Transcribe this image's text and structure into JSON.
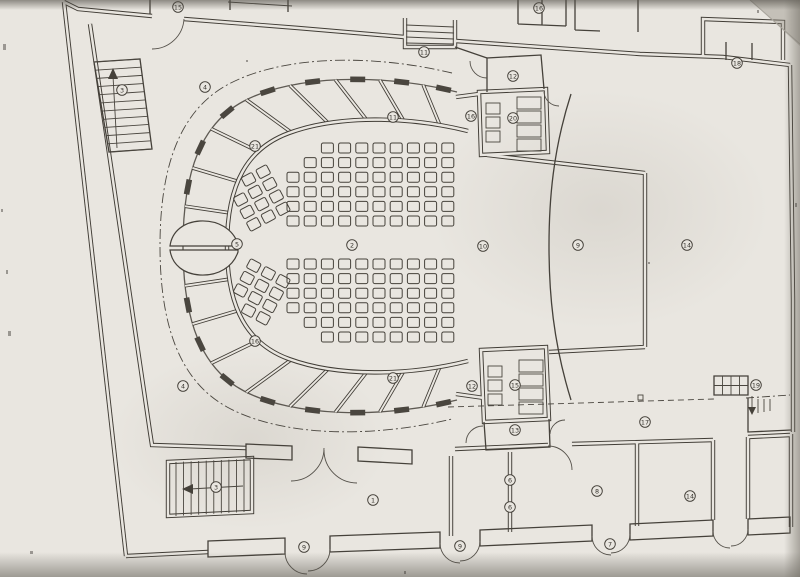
{
  "plan": {
    "colors": {
      "paper": "#e9e6e0",
      "ink": "#403c35",
      "ink_soft": "#6b675f",
      "edge_shadow": "#8f8b82"
    },
    "room_labels": [
      {
        "n": "3",
        "x": 122,
        "y": 90
      },
      {
        "n": "15",
        "x": 178,
        "y": 7
      },
      {
        "n": "4",
        "x": 205,
        "y": 87
      },
      {
        "n": "21",
        "x": 255,
        "y": 146
      },
      {
        "n": "11",
        "x": 424,
        "y": 52
      },
      {
        "n": "16",
        "x": 539,
        "y": 8
      },
      {
        "n": "12",
        "x": 513,
        "y": 76
      },
      {
        "n": "16",
        "x": 471,
        "y": 116
      },
      {
        "n": "20",
        "x": 513,
        "y": 118
      },
      {
        "n": "11",
        "x": 393,
        "y": 117
      },
      {
        "n": "18",
        "x": 737,
        "y": 63
      },
      {
        "n": "5",
        "x": 237,
        "y": 244
      },
      {
        "n": "2",
        "x": 352,
        "y": 245
      },
      {
        "n": "10",
        "x": 483,
        "y": 246
      },
      {
        "n": "9",
        "x": 578,
        "y": 245
      },
      {
        "n": "14",
        "x": 687,
        "y": 245
      },
      {
        "n": "16",
        "x": 255,
        "y": 341
      },
      {
        "n": "21",
        "x": 393,
        "y": 378
      },
      {
        "n": "4",
        "x": 183,
        "y": 386
      },
      {
        "n": "12",
        "x": 472,
        "y": 386
      },
      {
        "n": "15",
        "x": 515,
        "y": 385
      },
      {
        "n": "13",
        "x": 515,
        "y": 430
      },
      {
        "n": "17",
        "x": 645,
        "y": 422
      },
      {
        "n": "19",
        "x": 756,
        "y": 385
      },
      {
        "n": "6",
        "x": 510,
        "y": 480
      },
      {
        "n": "6",
        "x": 510,
        "y": 507
      },
      {
        "n": "8",
        "x": 597,
        "y": 491
      },
      {
        "n": "14",
        "x": 690,
        "y": 496
      },
      {
        "n": "9",
        "x": 460,
        "y": 546
      },
      {
        "n": "7",
        "x": 610,
        "y": 544
      },
      {
        "n": "9",
        "x": 304,
        "y": 547
      },
      {
        "n": "1",
        "x": 373,
        "y": 500
      },
      {
        "n": "3",
        "x": 216,
        "y": 487
      }
    ],
    "seat_blocks": [
      {
        "x": 287,
        "y": 143,
        "cols": 10,
        "rows": 6,
        "dx": 17.2,
        "dy": 14.6,
        "w": 12,
        "h": 10,
        "rotate": 0,
        "skip": [
          [
            0,
            0
          ],
          [
            1,
            0
          ],
          [
            0,
            1
          ]
        ]
      },
      {
        "x": 287,
        "y": 259,
        "cols": 10,
        "rows": 6,
        "dx": 17.2,
        "dy": 14.6,
        "w": 12,
        "h": 10,
        "rotate": 0,
        "skip": [
          [
            0,
            4
          ],
          [
            0,
            5
          ],
          [
            1,
            5
          ]
        ]
      },
      {
        "x": 236,
        "y": 172,
        "cols": 3,
        "rows": 4,
        "dx": 16.5,
        "dy": 14,
        "w": 12,
        "h": 10,
        "rotate": -28,
        "skip": [
          [
            0,
            0
          ]
        ]
      },
      {
        "x": 236,
        "y": 266,
        "cols": 3,
        "rows": 4,
        "dx": 16.5,
        "dy": 14,
        "w": 12,
        "h": 10,
        "rotate": 28,
        "skip": [
          [
            0,
            3
          ]
        ]
      }
    ],
    "loges": {
      "divider_t": [
        0.045,
        0.102,
        0.16,
        0.22,
        0.28,
        0.34,
        0.397,
        0.448,
        0.552,
        0.603,
        0.66,
        0.72,
        0.78,
        0.84,
        0.898,
        0.955
      ],
      "pier_t": [
        0.018,
        0.0735,
        0.131,
        0.19,
        0.25,
        0.31,
        0.3685,
        0.4225,
        0.5775,
        0.631,
        0.69,
        0.75,
        0.81,
        0.869,
        0.9265,
        0.982
      ]
    }
  }
}
